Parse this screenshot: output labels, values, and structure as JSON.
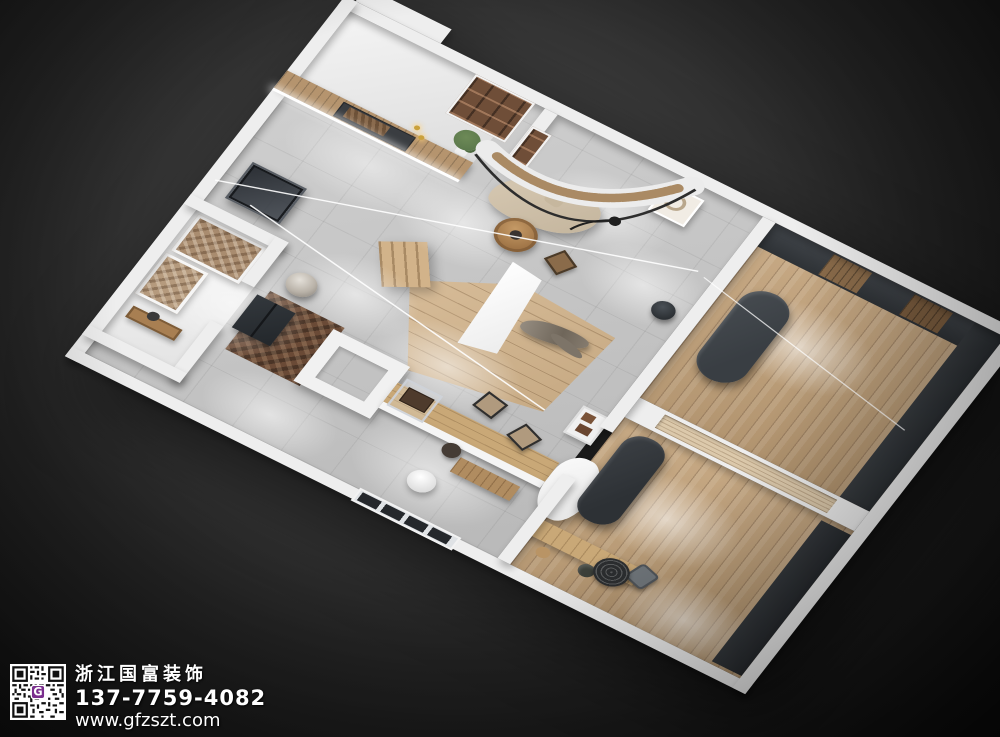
{
  "image": {
    "description": "3D isometric render of an interior floor plan with lounge, gallery, reception hall, wood platform and two wood-floor rooms, on a dark background"
  },
  "watermark": {
    "company_name": "浙江国富装饰",
    "phone": "137-7759-4082",
    "website": "www.gfzszt.com",
    "qr_center_letter": "G"
  },
  "palette": {
    "bgA": "#4a4a4a",
    "bgB": "#0e0e0e",
    "wall": "#eeeeee",
    "tile": "#c9c9c9",
    "woodL": "#d2b38a",
    "woodM": "#c2a178",
    "woodD": "#6a4a36",
    "graphite": "#33373b",
    "sofa": "#d7c9b3",
    "metal": "#b9b2a8",
    "green": "#5d7a4d",
    "purple": "#7b2f8e",
    "txt": "#ffffff"
  }
}
